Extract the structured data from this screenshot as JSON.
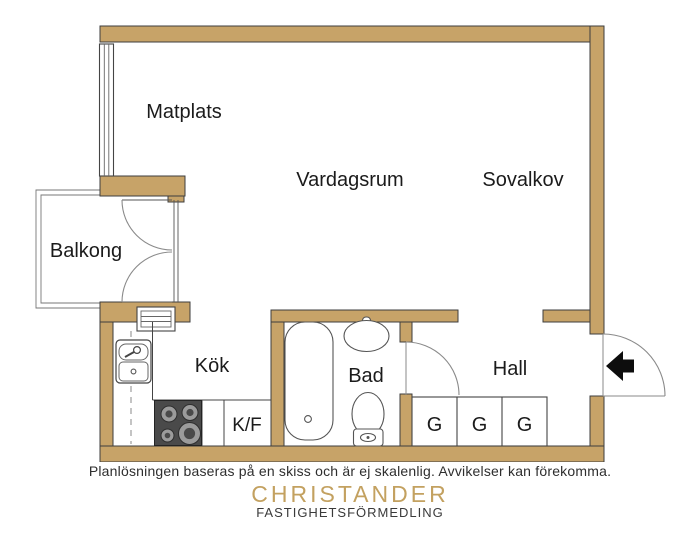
{
  "plan": {
    "rooms": [
      {
        "name": "matplats",
        "label": "Matplats"
      },
      {
        "name": "vardagsrum",
        "label": "Vardagsrum"
      },
      {
        "name": "sovalkov",
        "label": "Sovalkov"
      },
      {
        "name": "balkong",
        "label": "Balkong"
      },
      {
        "name": "kok",
        "label": "Kök"
      },
      {
        "name": "bad",
        "label": "Bad"
      },
      {
        "name": "hall",
        "label": "Hall"
      }
    ],
    "appliance_labels": {
      "fridge_freezer": "K/F"
    },
    "wardrobes": [
      "G",
      "G",
      "G"
    ],
    "colors": {
      "wall": "#c7a368",
      "wall_outline": "#3e3e3e",
      "fixture_line": "#555555",
      "door_arc": "#8a8a8a",
      "entry_arrow": "#0d0d0d"
    }
  },
  "footer": {
    "disclaimer": "Planlösningen baseras på en skiss och är ej skalenlig. Avvikelser kan förekomma.",
    "brand_name": "CHRISTANDER",
    "brand_tagline": "FASTIGHETSFÖRMEDLING",
    "brand_color": "#c3a160"
  }
}
